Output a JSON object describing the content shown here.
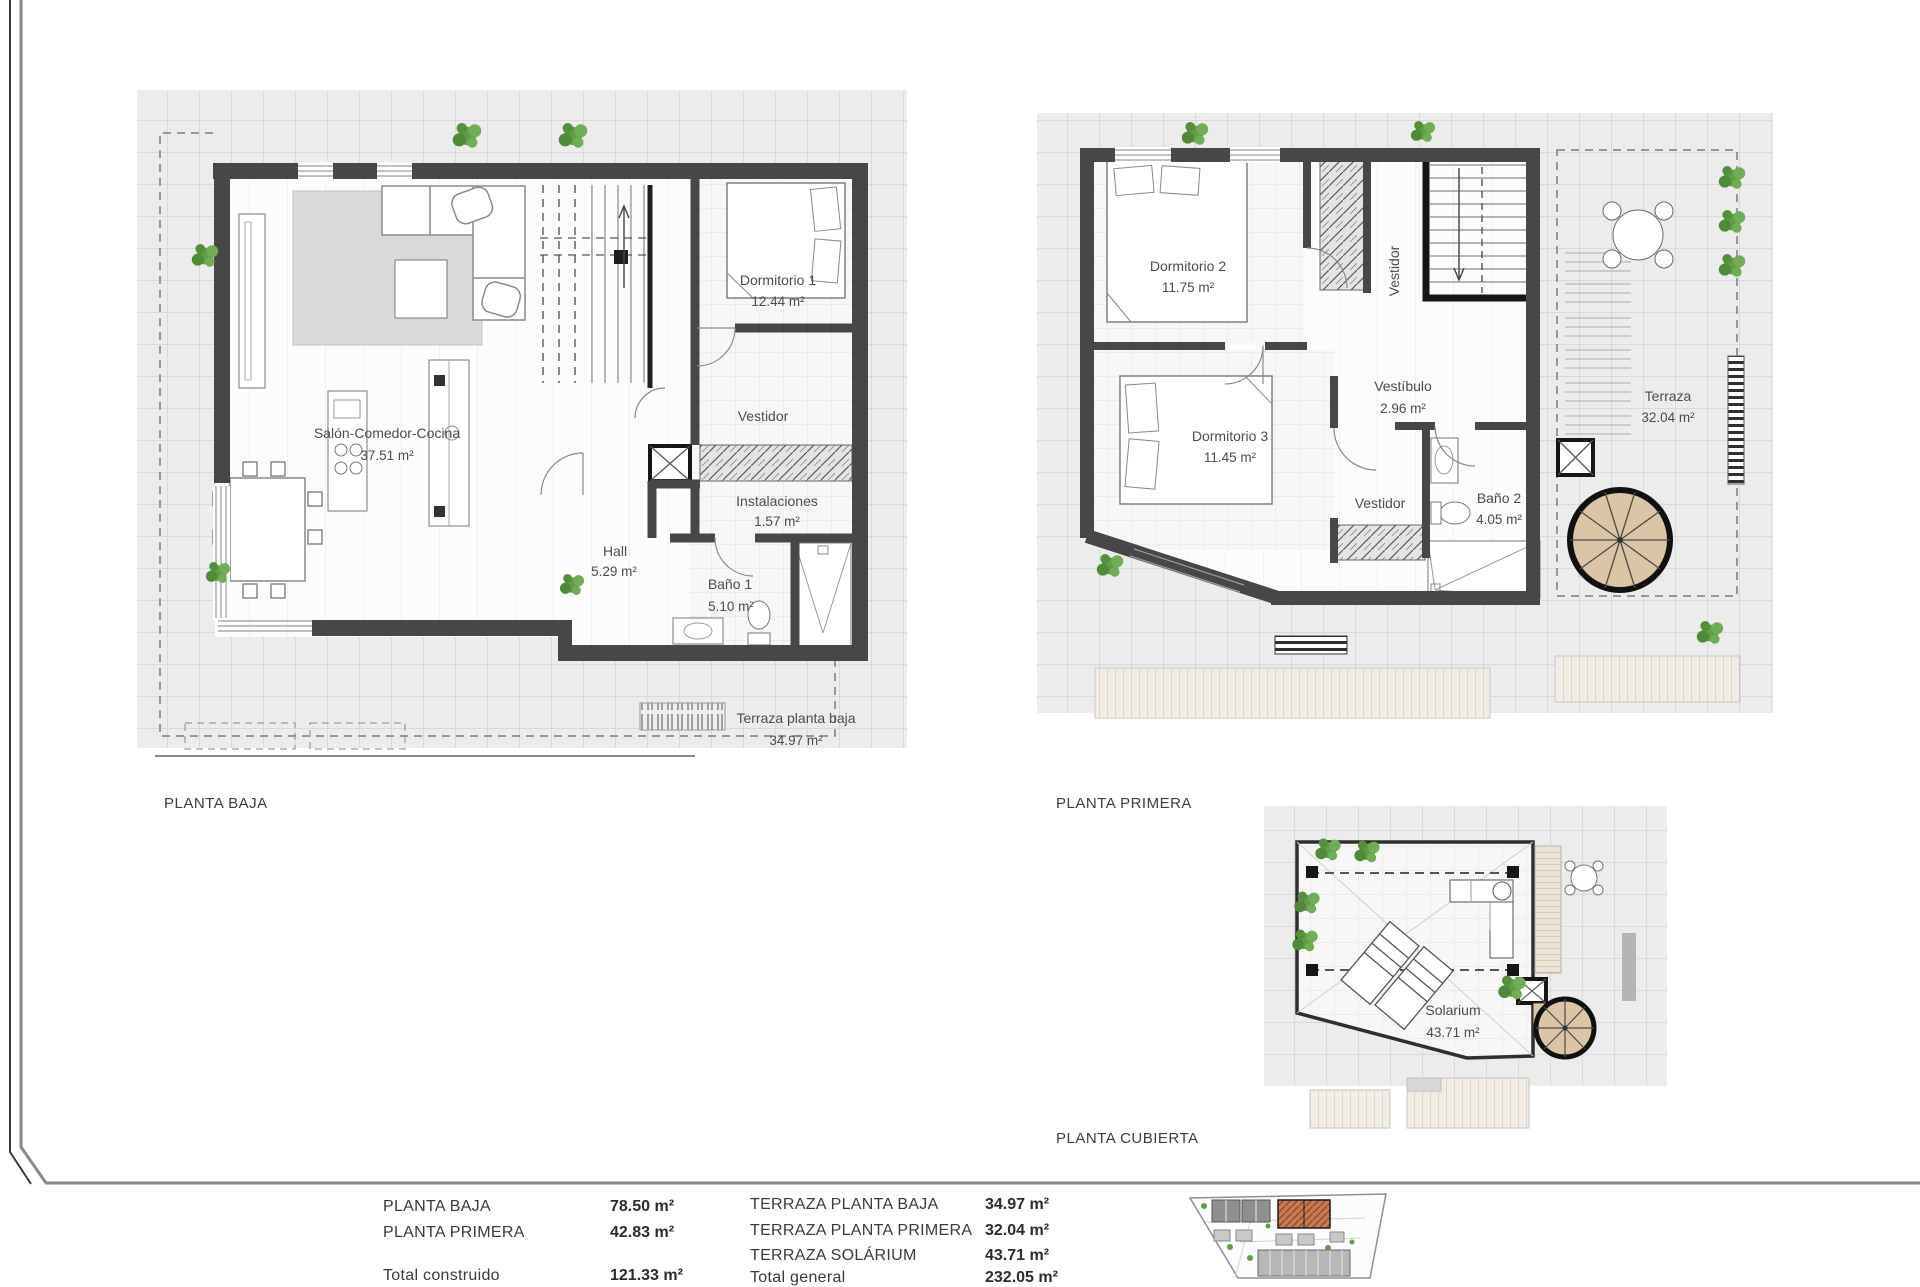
{
  "colors": {
    "wall": "#474747",
    "tile_line": "#c9c9c9",
    "plant_green": "#5f9e46",
    "stair_tan": "#dbc5a6",
    "site_highlight": "#c4714b"
  },
  "plans": {
    "baja": {
      "title": "PLANTA BAJA",
      "salon_name": "Salón-Comedor-Cocina",
      "salon_area": "37.51 m²",
      "dorm1_name": "Dormitorio 1",
      "dorm1_area": "12.44 m²",
      "vestidor": "Vestidor",
      "instalaciones_name": "Instalaciones",
      "instalaciones_area": "1.57 m²",
      "hall_name": "Hall",
      "hall_area": "5.29 m²",
      "bano_name": "Baño 1",
      "bano_area": "5.10 m²",
      "terraza_name": "Terraza planta baja",
      "terraza_area": "34.97 m²"
    },
    "primera": {
      "title": "PLANTA PRIMERA",
      "dorm2_name": "Dormitorio 2",
      "dorm2_area": "11.75 m²",
      "vestidor_v": "Vestidor",
      "vestibulo_name": "Vestíbulo",
      "vestibulo_area": "2.96 m²",
      "dorm3_name": "Dormitorio 3",
      "dorm3_area": "11.45 m²",
      "vestidor_h": "Vestidor",
      "bano2_name": "Baño 2",
      "bano2_area": "4.05 m²",
      "terraza_name": "Terraza",
      "terraza_area": "32.04 m²"
    },
    "cubierta": {
      "title": "PLANTA CUBIERTA",
      "solarium_name": "Solarium",
      "solarium_area": "43.71 m²"
    }
  },
  "summary": {
    "left_rows": [
      {
        "label": "PLANTA BAJA",
        "value": "78.50 m²"
      },
      {
        "label": "PLANTA PRIMERA",
        "value": "42.83 m²"
      },
      {
        "label": "Total construido",
        "value": "121.33 m²"
      }
    ],
    "right_rows": [
      {
        "label": "TERRAZA PLANTA BAJA",
        "value": "34.97 m²"
      },
      {
        "label": "TERRAZA PLANTA PRIMERA",
        "value": "32.04 m²"
      },
      {
        "label": "TERRAZA SOLÁRIUM",
        "value": "43.71 m²"
      },
      {
        "label": "Total general",
        "value": "232.05 m²"
      }
    ]
  }
}
